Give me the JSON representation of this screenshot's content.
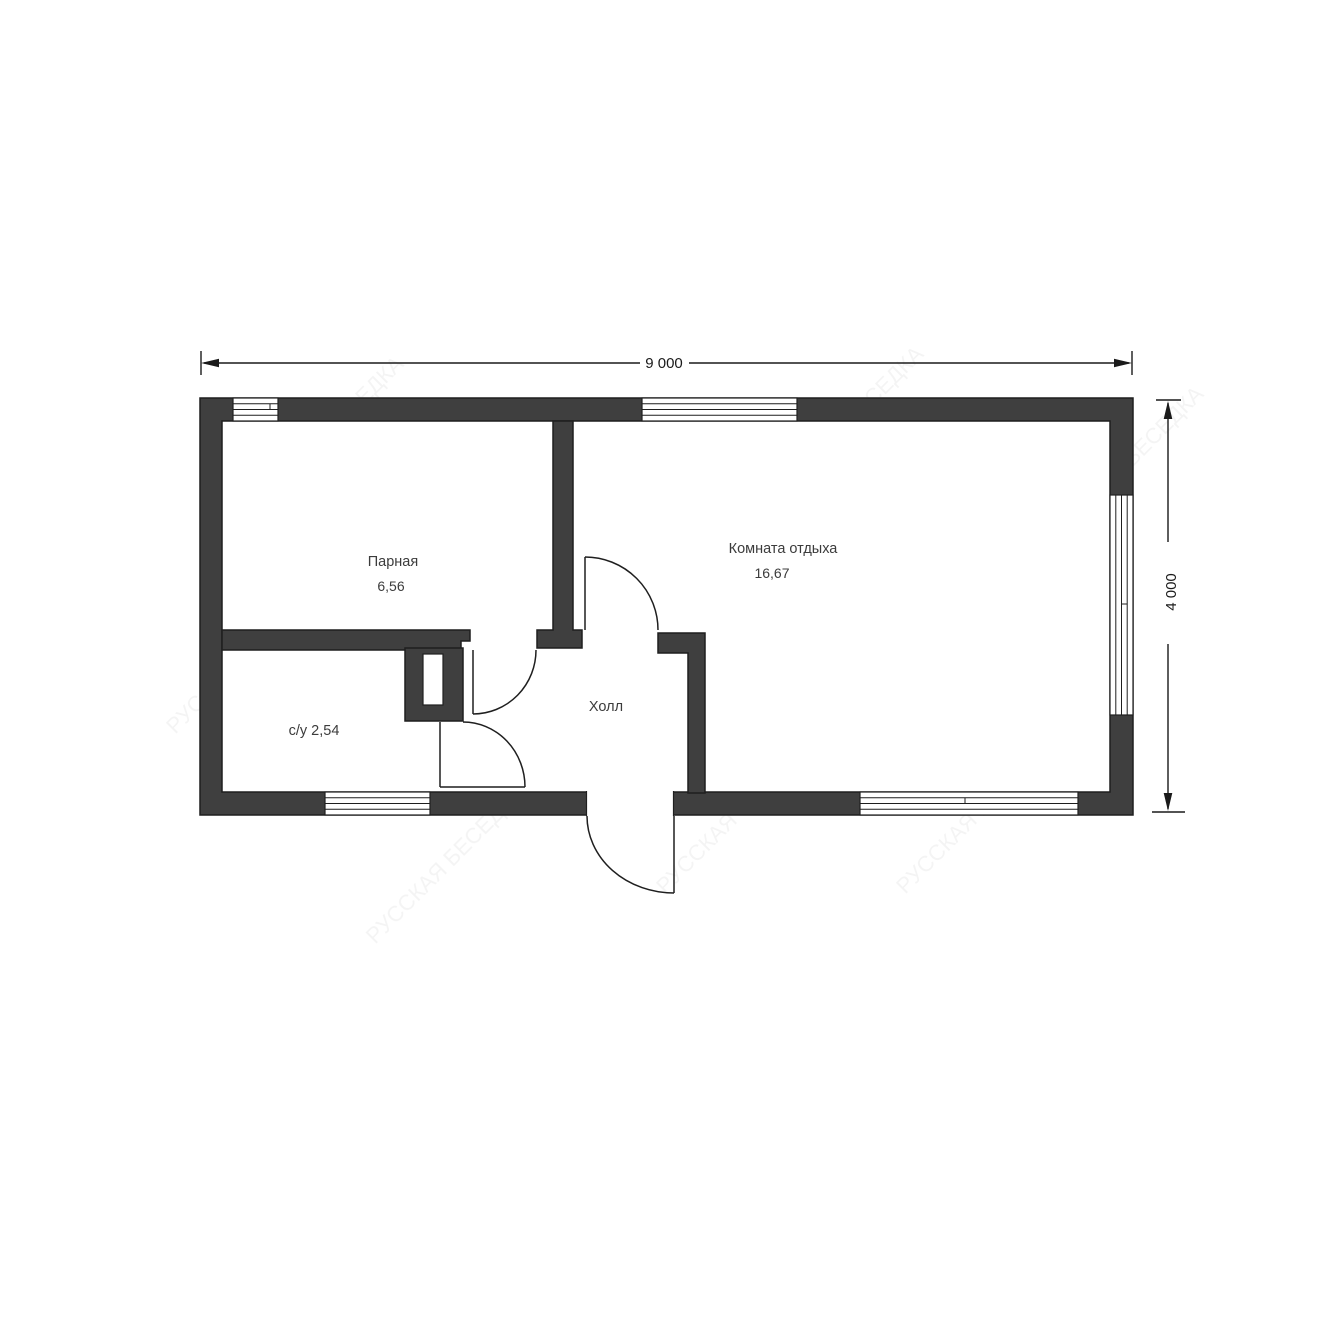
{
  "plan": {
    "title": "sauna-floor-plan",
    "watermark": "РУССКАЯ БЕСЕДКА",
    "colors": {
      "wall": "#3f3f3f",
      "line": "#1f1f1f",
      "text": "#3c3c3c",
      "background": "#ffffff"
    },
    "dimensions": {
      "width": "9 000",
      "height": "4 000"
    },
    "rooms": {
      "parnaya": {
        "label": "Парная",
        "area": "6,56"
      },
      "rest": {
        "label": "Комната отдыха",
        "area": "16,67"
      },
      "hall": {
        "label": "Холл"
      },
      "wc": {
        "label": "с/у 2,54"
      }
    }
  }
}
